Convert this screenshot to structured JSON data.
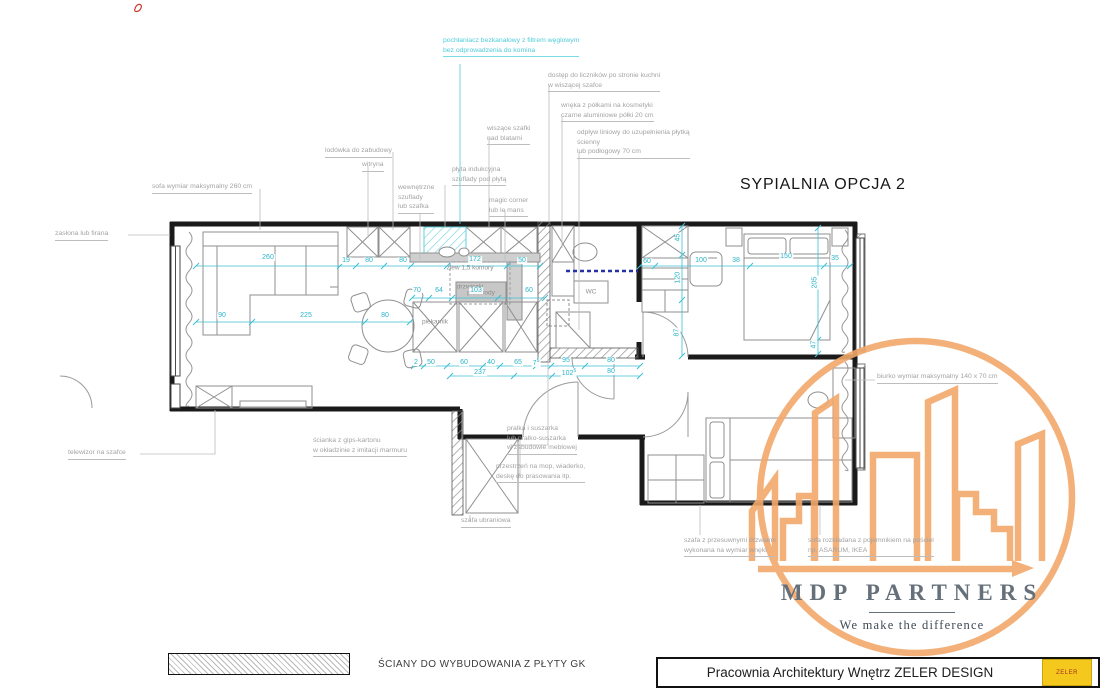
{
  "title": "SYPIALNIA OPCJA 2",
  "colors": {
    "dimension_cyan": "#2ab4c9",
    "annotation_gray": "#a3a3a3",
    "hood_cyan": "#4fccd9",
    "navy_partition": "#2531a6",
    "logo_orange": "#f2a86b",
    "stamp_yellow": "#f4c81c",
    "wall_black": "#1a1a1a"
  },
  "legend": {
    "label": "ŚCIANY DO WYBUDOWANIA Z PŁYTY GK"
  },
  "footer": {
    "studio": "Pracownia Architektury Wnętrz ZELER DESIGN",
    "stamp": "ZELER"
  },
  "logo": {
    "name": "MDP PARTNERS",
    "tagline": "We make the difference"
  },
  "callouts": [
    {
      "id": "hood",
      "lines": [
        "pochłaniacz bezkanałowy z filtrem węglowym",
        "bez odprowadzenia do komina"
      ],
      "x": 443,
      "y": 36,
      "color": "cyan"
    },
    {
      "id": "meters-access",
      "lines": [
        "dostęp do liczników po stronie kuchni",
        "w wiszącej szafce"
      ],
      "x": 548,
      "y": 71
    },
    {
      "id": "cosmetics-niche",
      "lines": [
        "wnęka z półkami na kosmetyki",
        "czarne aluminiowe półki 20 cm"
      ],
      "x": 561,
      "y": 101
    },
    {
      "id": "linear-drain",
      "lines": [
        "odpływ liniowy do uzupełnienia płytką",
        "ścienny",
        "lub podłogowy 70 cm"
      ],
      "x": 577,
      "y": 128
    },
    {
      "id": "hanging-cabinets",
      "lines": [
        "wiszące szafki",
        "nad blatami"
      ],
      "x": 487,
      "y": 124
    },
    {
      "id": "fridge",
      "lines": [
        "lodówka do zabudowy"
      ],
      "x": 325,
      "y": 146
    },
    {
      "id": "vitrine",
      "lines": [
        "witryna"
      ],
      "x": 362,
      "y": 160
    },
    {
      "id": "induction-hob",
      "lines": [
        "płyta indukcyjna",
        "szuflady pod płytą"
      ],
      "x": 452,
      "y": 165
    },
    {
      "id": "inner-drawers",
      "lines": [
        "wewnętrzne",
        "szuflady",
        "lub szafka"
      ],
      "x": 398,
      "y": 183
    },
    {
      "id": "magic-corner",
      "lines": [
        "magic corner",
        "lub le mans"
      ],
      "x": 489,
      "y": 196
    },
    {
      "id": "sofa-max",
      "lines": [
        "sofa wymiar maksymalny 260 cm"
      ],
      "x": 152,
      "y": 182
    },
    {
      "id": "curtain",
      "lines": [
        "zasłona lub firana"
      ],
      "x": 55,
      "y": 229
    },
    {
      "id": "tv",
      "lines": [
        "telewizor na szafce"
      ],
      "x": 68,
      "y": 448
    },
    {
      "id": "gk-partition",
      "lines": [
        "ścianka z gips-kartonu",
        "w okładzinie z imitacji marmuru"
      ],
      "x": 313,
      "y": 436
    },
    {
      "id": "washer",
      "lines": [
        "pralka i suszarka",
        "lub pralko-suszarka",
        "w zabudowie meblowej"
      ],
      "x": 507,
      "y": 424
    },
    {
      "id": "mop-space",
      "lines": [
        "przestrzeń na mop, wiaderko,",
        "deskę do prasowania itp."
      ],
      "x": 496,
      "y": 462
    },
    {
      "id": "wardrobe",
      "lines": [
        "szafa ubraniowa"
      ],
      "x": 461,
      "y": 516
    },
    {
      "id": "desk",
      "lines": [
        "biurko wymiar maksymalny 140 x 70 cm"
      ],
      "x": 877,
      "y": 372
    },
    {
      "id": "sliding-wardrobe",
      "lines": [
        "szafa z przesuwnymi drzwiami",
        "wykonana na wymiar wnęki"
      ],
      "x": 684,
      "y": 536
    },
    {
      "id": "sofa-bed",
      "lines": [
        "sofa rozkładana z pojemnikiem na pościel",
        "np. ASARUM, IKEA"
      ],
      "x": 808,
      "y": 536
    }
  ],
  "room_labels": [
    {
      "t": "WC",
      "x": 591,
      "y": 292
    },
    {
      "t": "zlew 1,5 komory",
      "x": 470,
      "y": 268
    },
    {
      "t": "piekarnik",
      "x": 435,
      "y": 322
    },
    {
      "t": "drzwiczki",
      "x": 470,
      "y": 287
    },
    {
      "t": "przewody",
      "x": 481,
      "y": 293
    }
  ],
  "dimensions": [
    {
      "t": "260",
      "x": 268,
      "y": 258
    },
    {
      "t": "19",
      "x": 346,
      "y": 261
    },
    {
      "t": "80",
      "x": 369,
      "y": 261
    },
    {
      "t": "80",
      "x": 403,
      "y": 261
    },
    {
      "t": "172",
      "x": 475,
      "y": 260
    },
    {
      "t": "50",
      "x": 522,
      "y": 261
    },
    {
      "t": "90",
      "x": 222,
      "y": 316
    },
    {
      "t": "225",
      "x": 306,
      "y": 316
    },
    {
      "t": "80",
      "x": 385,
      "y": 316
    },
    {
      "t": "70",
      "x": 417,
      "y": 291
    },
    {
      "t": "64",
      "x": 439,
      "y": 291
    },
    {
      "t": "103",
      "x": 476,
      "y": 291
    },
    {
      "t": "60",
      "x": 529,
      "y": 291
    },
    {
      "t": "2",
      "x": 416,
      "y": 363
    },
    {
      "t": "50",
      "x": 431,
      "y": 363
    },
    {
      "t": "60",
      "x": 464,
      "y": 363
    },
    {
      "t": "40",
      "x": 491,
      "y": 363
    },
    {
      "t": "65",
      "x": 518,
      "y": 363
    },
    {
      "t": "7",
      "sup": "5",
      "x": 536,
      "y": 363
    },
    {
      "t": "95",
      "x": 566,
      "y": 361
    },
    {
      "t": "80",
      "x": 611,
      "y": 361
    },
    {
      "t": "237",
      "x": 480,
      "y": 373
    },
    {
      "t": "102",
      "sup": "5",
      "x": 569,
      "y": 373
    },
    {
      "t": "80",
      "x": 611,
      "y": 372
    },
    {
      "t": "60",
      "x": 647,
      "y": 262
    },
    {
      "t": "100",
      "x": 701,
      "y": 261
    },
    {
      "t": "38",
      "x": 736,
      "y": 261
    },
    {
      "t": "150",
      "x": 786,
      "y": 257
    },
    {
      "t": "35",
      "x": 835,
      "y": 259
    },
    {
      "t": "45",
      "x": 678,
      "y": 238,
      "v": true
    },
    {
      "t": "120",
      "x": 678,
      "y": 278,
      "v": true
    },
    {
      "t": "87",
      "x": 677,
      "y": 333,
      "v": true
    },
    {
      "t": "205",
      "x": 815,
      "y": 283,
      "v": true
    },
    {
      "t": "47",
      "x": 814,
      "y": 345,
      "v": true
    }
  ]
}
